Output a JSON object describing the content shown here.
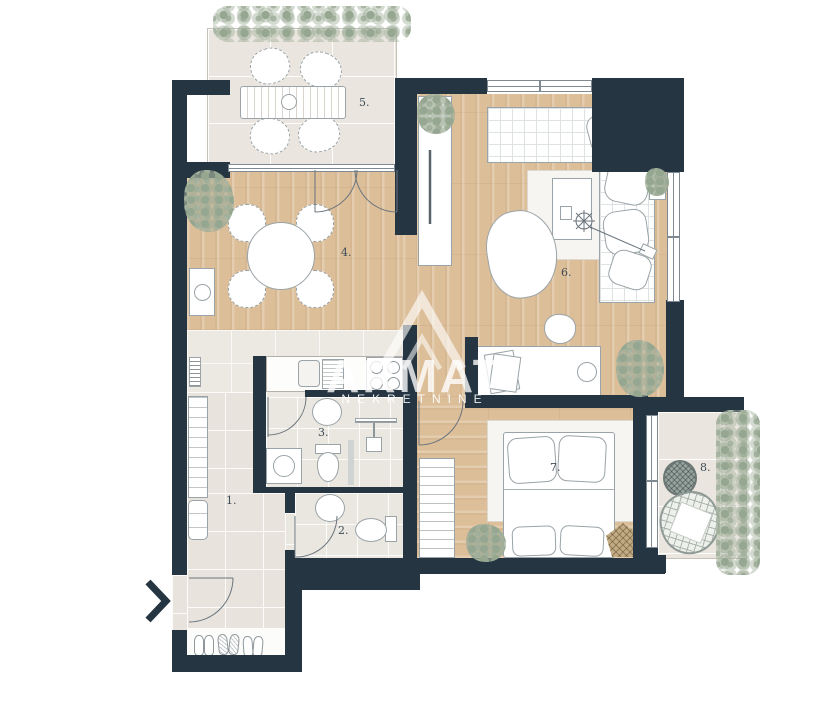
{
  "plan": {
    "rooms": [
      {
        "name": "hallway",
        "label": "1."
      },
      {
        "name": "toilet",
        "label": "2."
      },
      {
        "name": "bathroom",
        "label": "3."
      },
      {
        "name": "kitchen-dining",
        "label": "4."
      },
      {
        "name": "terrace",
        "label": "5."
      },
      {
        "name": "living-room",
        "label": "6."
      },
      {
        "name": "bedroom",
        "label": "7."
      },
      {
        "name": "balcony",
        "label": "8."
      }
    ],
    "watermark": {
      "brand": "ARMAT",
      "subtitle": "NEKRETNINE",
      "logo": "mountain-monogram-icon"
    },
    "colors": {
      "wall": "#253541",
      "wood_floor": "#dcbe99",
      "tile_floor": "#e9e5de",
      "greenery": "#96a791",
      "background": "#ffffff"
    }
  }
}
